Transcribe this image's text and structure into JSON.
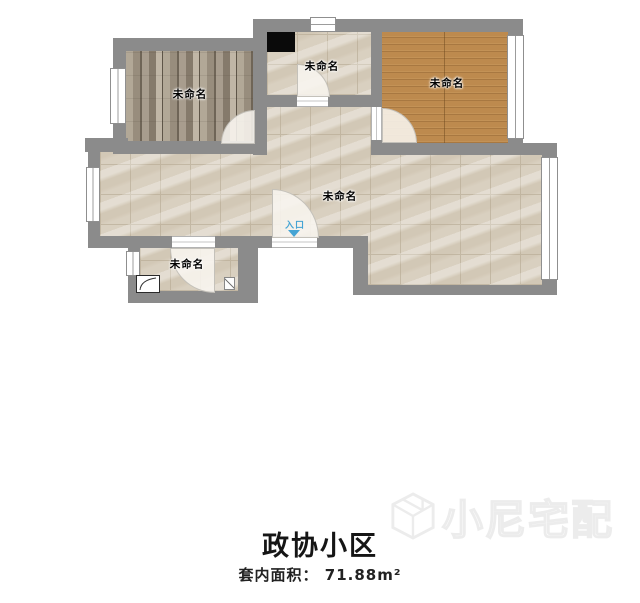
{
  "floorplan": {
    "rooms": [
      {
        "id": "room-top-left",
        "label": "未命名",
        "floor": "gray-wood"
      },
      {
        "id": "kitchen",
        "label": "未命名",
        "floor": "tile"
      },
      {
        "id": "room-top-right",
        "label": "未命名",
        "floor": "orange-wood"
      },
      {
        "id": "living-area",
        "label": "未命名",
        "floor": "tile"
      },
      {
        "id": "bathroom",
        "label": "未命名",
        "floor": "tile"
      }
    ],
    "entrance_label": "入口",
    "title": "政协小区",
    "area_label": "套内面积：",
    "area_value": "71.88m²",
    "watermark_text": "小尼宅配",
    "colors": {
      "wall": "#8b8b8b",
      "tile_floor": "#d9d0c0",
      "gray_wood_floor": "#a29686",
      "orange_wood_floor": "#bd8a4e",
      "entrance_blue": "#45a4d4"
    }
  }
}
